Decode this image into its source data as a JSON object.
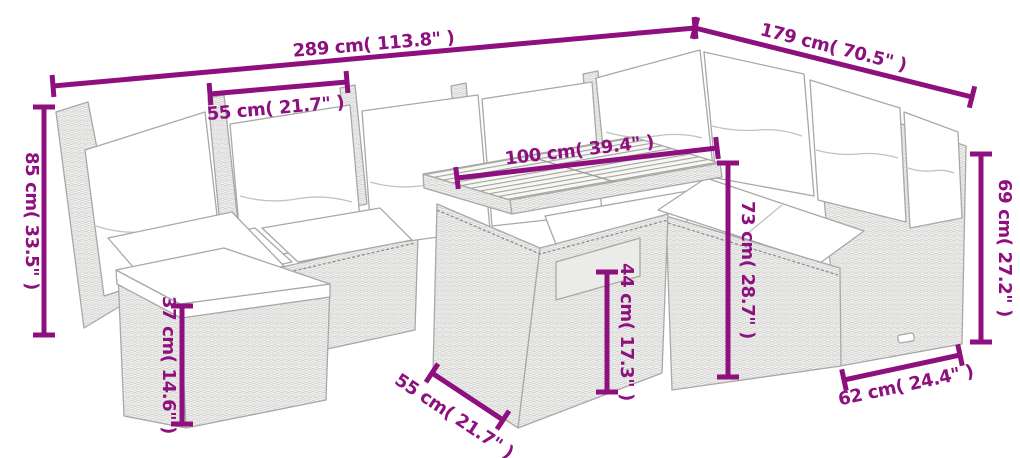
{
  "figure": {
    "alt": "Line drawing of an L-shaped rattan garden sofa set with back cushions, footstool and slatted-top table, annotated with dimension lines"
  },
  "colors": {
    "dimension_accent": "#8D107E",
    "line_art": "#A8A8A8"
  },
  "dimensions": {
    "total_width": "289 cm( 113.8\" )",
    "total_depth": "179 cm( 70.5\" )",
    "seat_width": "55 cm( 21.7\" )",
    "total_height": "85 cm( 33.5\" )",
    "table_length": "100 cm( 39.4\" )",
    "back_height": "69 cm( 27.2\" )",
    "corner_height": "73 cm( 28.7\" )",
    "table_height": "44 cm( 17.3\" )",
    "ottoman_height": "37 cm( 14.6\" )",
    "table_width": "55 cm( 21.7\" )",
    "seat_depth": "62 cm( 24.4\" )"
  }
}
